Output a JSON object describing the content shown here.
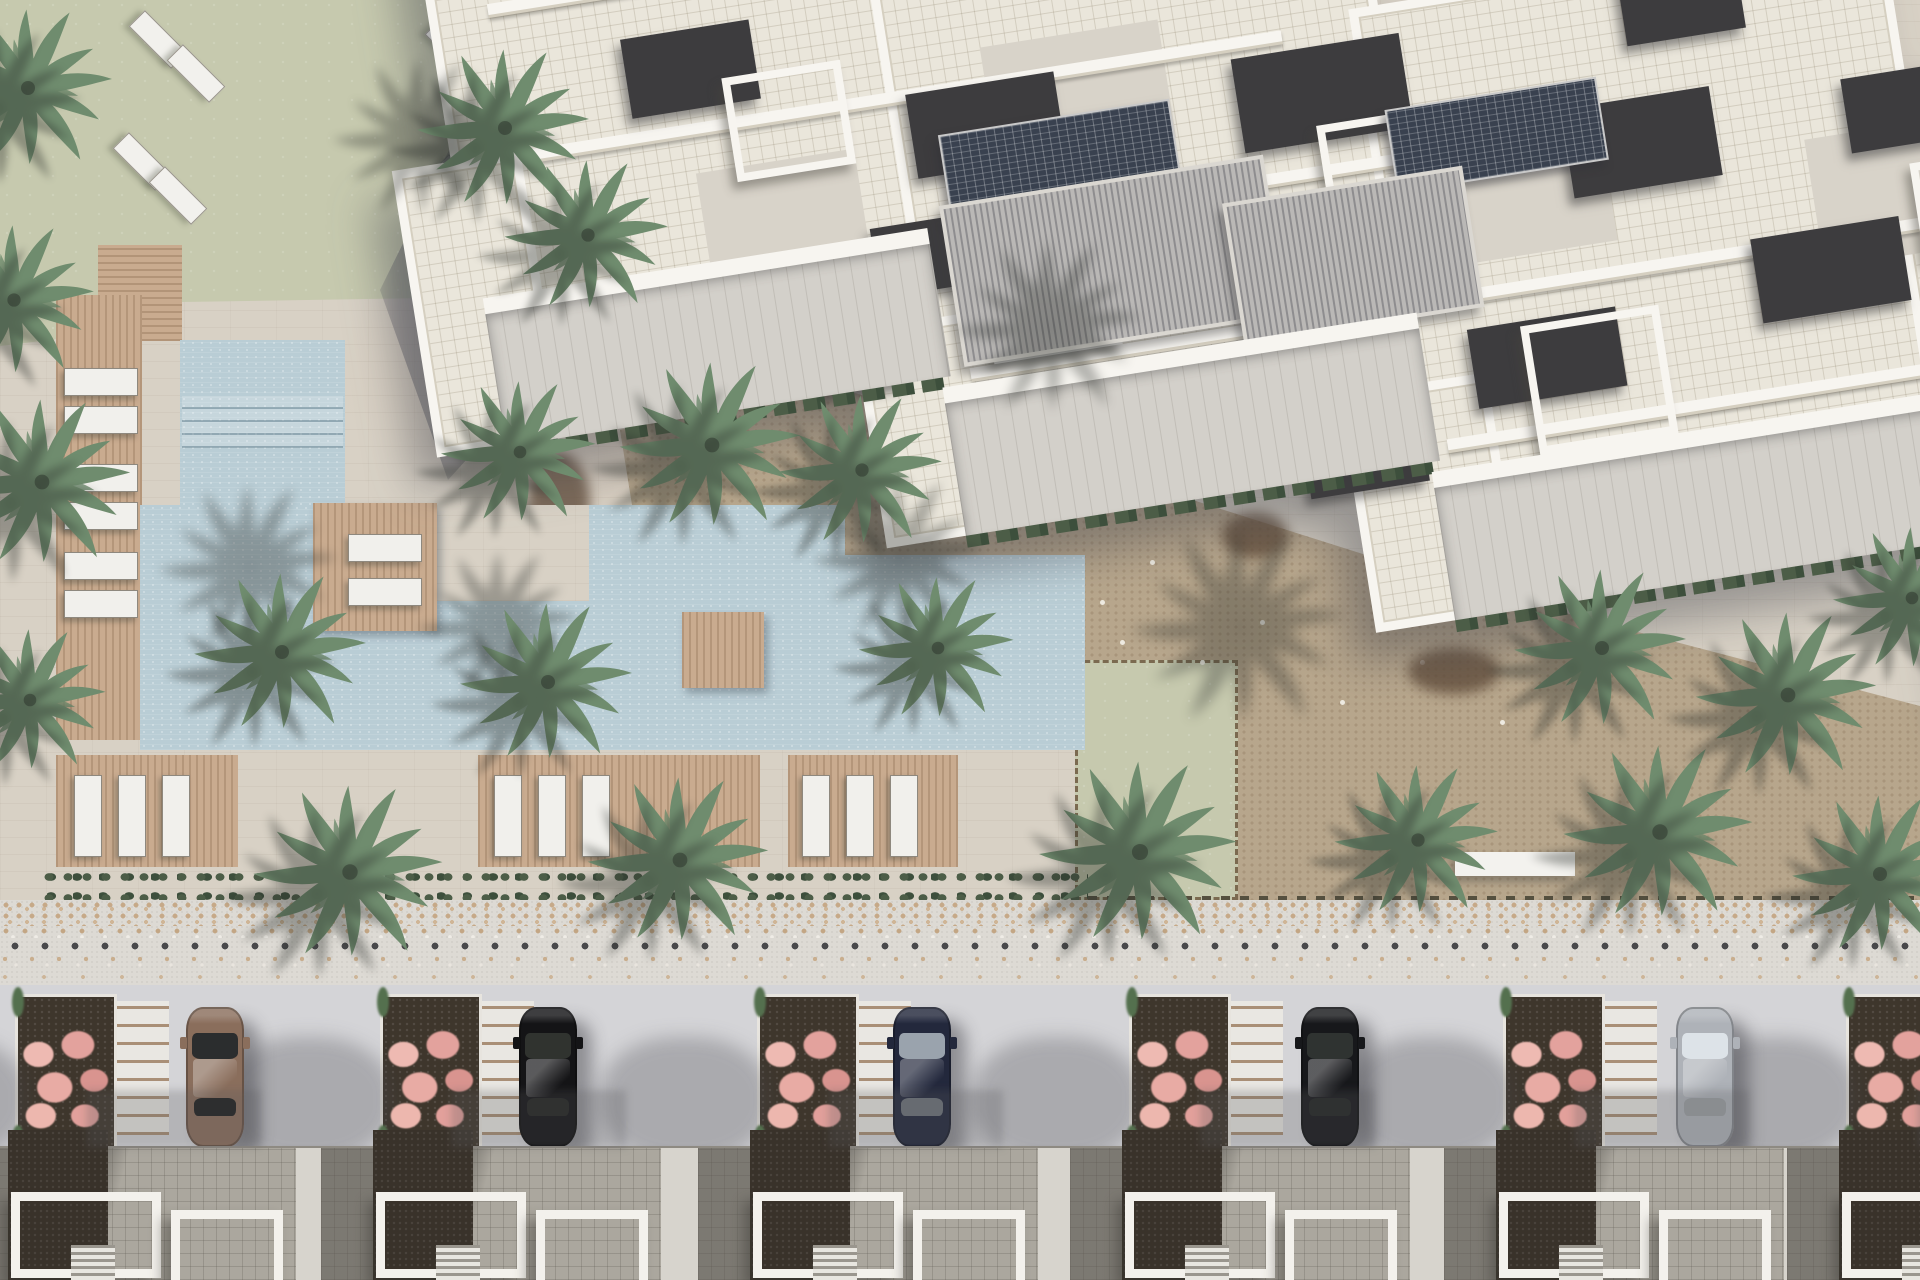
{
  "scene": {
    "type": "aerial-architectural-render",
    "description": "top-down site plan of residential resort: pool with wood decks, lawn, apartment building with solar panels, palm plaza, promenade, street parking, townhouses"
  },
  "palette": {
    "pav": "#d8d1c5",
    "lawn": "#c6c9ae",
    "water": "#b9cdd5",
    "wood": "#c9ab8f",
    "plaza": "#b7a68c",
    "walk": "#dddad4",
    "street": "#d4d4d7",
    "cream": "#eae6db",
    "charcoal": "#3d3c3e",
    "solar": "#39414f",
    "pink": "#e8aba4",
    "palm": "#6f8c6e",
    "white": "#f3f1ec"
  },
  "lawnLoungers": [
    {
      "x": 128,
      "y": 28,
      "r": "45deg"
    },
    {
      "x": 166,
      "y": 62,
      "r": "45deg"
    },
    {
      "x": 112,
      "y": 150,
      "r": "45deg"
    },
    {
      "x": 148,
      "y": 184,
      "r": "45deg"
    },
    {
      "x": 424,
      "y": 36,
      "r": "45deg"
    },
    {
      "x": 460,
      "y": 70,
      "r": "45deg"
    },
    {
      "x": 432,
      "y": 172,
      "r": "45deg",
      "cls": "shade"
    }
  ],
  "deckLoungers": [
    {
      "x": 64,
      "y": 368
    },
    {
      "x": 64,
      "y": 406
    },
    {
      "x": 64,
      "y": 464
    },
    {
      "x": 64,
      "y": 502
    },
    {
      "x": 64,
      "y": 552
    },
    {
      "x": 64,
      "y": 590
    }
  ],
  "islandLoungers": [
    {
      "x": 348,
      "y": 534
    },
    {
      "x": 348,
      "y": 578
    }
  ],
  "platforms": [
    {
      "x": 56,
      "y": 755,
      "w": 182
    },
    {
      "x": 478,
      "y": 755,
      "w": 282
    },
    {
      "x": 788,
      "y": 755,
      "w": 170
    }
  ],
  "platformLoungers": [
    {
      "x": 74,
      "y": 775
    },
    {
      "x": 118,
      "y": 775
    },
    {
      "x": 162,
      "y": 775
    },
    {
      "x": 494,
      "y": 775
    },
    {
      "x": 538,
      "y": 775
    },
    {
      "x": 582,
      "y": 775
    },
    {
      "x": 802,
      "y": 775
    },
    {
      "x": 846,
      "y": 775
    },
    {
      "x": 890,
      "y": 775
    }
  ],
  "palms": [
    {
      "x": 28,
      "y": 88,
      "s": "1"
    },
    {
      "x": 14,
      "y": 300,
      "s": "0.95"
    },
    {
      "x": 42,
      "y": 482,
      "s": "1.05"
    },
    {
      "x": 30,
      "y": 700,
      "s": "0.9"
    },
    {
      "x": 505,
      "y": 128,
      "s": "1"
    },
    {
      "x": 588,
      "y": 235,
      "s": "0.95"
    },
    {
      "x": 520,
      "y": 452,
      "s": "0.9"
    },
    {
      "x": 712,
      "y": 445,
      "s": "1.05"
    },
    {
      "x": 862,
      "y": 470,
      "s": "0.95"
    },
    {
      "x": 282,
      "y": 652,
      "s": "1"
    },
    {
      "x": 548,
      "y": 682,
      "s": "1"
    },
    {
      "x": 938,
      "y": 648,
      "s": "0.9"
    },
    {
      "x": 350,
      "y": 872,
      "s": "1.1"
    },
    {
      "x": 680,
      "y": 860,
      "s": "1.05"
    },
    {
      "x": 1140,
      "y": 852,
      "s": "1.15"
    },
    {
      "x": 1418,
      "y": 840,
      "s": "0.95"
    },
    {
      "x": 1660,
      "y": 832,
      "s": "1.1"
    },
    {
      "x": 1880,
      "y": 874,
      "s": "1"
    },
    {
      "x": 1602,
      "y": 648,
      "s": "1"
    },
    {
      "x": 1788,
      "y": 695,
      "s": "1.05"
    },
    {
      "x": 1912,
      "y": 598,
      "s": "0.9"
    }
  ],
  "palmShadows": [
    {
      "x": 250,
      "y": 570,
      "s": "1.05"
    },
    {
      "x": 500,
      "y": 628,
      "s": "0.95"
    },
    {
      "x": 900,
      "y": 560,
      "s": "1"
    },
    {
      "x": 1240,
      "y": 630,
      "s": "1.25"
    },
    {
      "x": 420,
      "y": 140,
      "s": "1"
    },
    {
      "x": 1050,
      "y": 330,
      "s": "1.1"
    }
  ],
  "building": {
    "wings": [
      {
        "x": 60,
        "y": 20,
        "w": 470,
        "h": 600
      },
      {
        "x": 500,
        "y": 170,
        "w": 500,
        "h": 610
      },
      {
        "x": 970,
        "y": 320,
        "w": 540,
        "h": 620
      },
      {
        "x": 1480,
        "y": 470,
        "w": 420,
        "h": 630
      },
      {
        "x": 0,
        "y": 330,
        "w": 130,
        "h": 290
      },
      {
        "x": 430,
        "y": 560,
        "w": 150,
        "h": 220
      },
      {
        "x": 900,
        "y": 700,
        "w": 150,
        "h": 240
      }
    ],
    "bands": [
      {
        "x": 140,
        "y": 330,
        "w": 760
      },
      {
        "x": 300,
        "y": 470,
        "w": 800
      },
      {
        "x": 540,
        "y": 615,
        "w": 960
      },
      {
        "x": 1000,
        "y": 760,
        "w": 800
      },
      {
        "x": 120,
        "y": 180,
        "w": 600
      }
    ],
    "charcoal": [
      {
        "x": 519,
        "y": 335,
        "w": 150,
        "h": 85
      },
      {
        "x": 846,
        "y": 351,
        "w": 170,
        "h": 95
      },
      {
        "x": 246,
        "y": 236,
        "w": 130,
        "h": 80
      },
      {
        "x": 463,
        "y": 462,
        "w": 120,
        "h": 70
      },
      {
        "x": 1164,
        "y": 452,
        "w": 150,
        "h": 90
      },
      {
        "x": 1037,
        "y": 655,
        "w": 150,
        "h": 80
      },
      {
        "x": 857,
        "y": 728,
        "w": 120,
        "h": 70
      },
      {
        "x": 1331,
        "y": 610,
        "w": 150,
        "h": 85
      },
      {
        "x": 1445,
        "y": 466,
        "w": 130,
        "h": 75
      },
      {
        "x": 380,
        "y": 560,
        "w": 100,
        "h": 60
      },
      {
        "x": 700,
        "y": 640,
        "w": 110,
        "h": 65
      },
      {
        "x": 1240,
        "y": 330,
        "w": 120,
        "h": 70
      }
    ],
    "whiteFrames": [
      {
        "x": 565,
        "y": 505,
        "w": 130,
        "h": 110
      },
      {
        "x": 1090,
        "y": 660,
        "w": 140,
        "h": 130
      },
      {
        "x": 340,
        "y": 290,
        "w": 120,
        "h": 105
      },
      {
        "x": 920,
        "y": 430,
        "w": 110,
        "h": 95
      },
      {
        "x": 1500,
        "y": 560,
        "w": 120,
        "h": 100
      }
    ],
    "roofPatches": [
      {
        "x": 600,
        "y": 300,
        "w": 180,
        "h": 120
      },
      {
        "x": 1000,
        "y": 450,
        "w": 200,
        "h": 140
      },
      {
        "x": 1400,
        "y": 520,
        "w": 180,
        "h": 130
      },
      {
        "x": 300,
        "y": 380,
        "w": 160,
        "h": 110
      }
    ],
    "solar": [
      {
        "x": 545,
        "y": 380,
        "w": 230,
        "h": 85
      },
      {
        "x": 990,
        "y": 425,
        "w": 210,
        "h": 80
      }
    ],
    "pergolas": [
      {
        "x": 535,
        "y": 450,
        "w": 320,
        "h": 155
      },
      {
        "x": 815,
        "y": 492,
        "w": 235,
        "h": 135
      }
    ],
    "terraces": [
      {
        "x": 70,
        "y": 470,
        "w": 450,
        "h": 150
      },
      {
        "x": 510,
        "y": 630,
        "w": 480,
        "h": 150
      },
      {
        "x": 980,
        "y": 790,
        "w": 520,
        "h": 150
      },
      {
        "x": 1490,
        "y": 950,
        "w": 400,
        "h": 150
      }
    ]
  },
  "plaza": {
    "bench": {
      "x": 1455,
      "y": 852,
      "w": 120,
      "h": 24
    },
    "specks": [
      {
        "x": 1060,
        "y": 560
      },
      {
        "x": 1100,
        "y": 600
      },
      {
        "x": 1150,
        "y": 560
      },
      {
        "x": 1120,
        "y": 640
      },
      {
        "x": 1200,
        "y": 660
      },
      {
        "x": 1260,
        "y": 620
      },
      {
        "x": 1340,
        "y": 700
      },
      {
        "x": 1420,
        "y": 660
      },
      {
        "x": 1500,
        "y": 720
      },
      {
        "x": 1580,
        "y": 680
      }
    ],
    "bushes": [
      {
        "x": 528,
        "y": 452,
        "w": 62,
        "h": 100
      },
      {
        "x": 1408,
        "y": 648,
        "w": 92,
        "h": 46
      },
      {
        "x": 1222,
        "y": 512,
        "w": 66,
        "h": 46
      }
    ],
    "greenPatch": {
      "x": 1075,
      "y": 660,
      "w": 163,
      "h": 240
    }
  },
  "parking": {
    "planters": [
      {
        "x": 18
      },
      {
        "x": 383
      },
      {
        "x": 760
      },
      {
        "x": 1132
      },
      {
        "x": 1506
      },
      {
        "x": 1849
      }
    ],
    "cars": [
      {
        "x": 186,
        "c": "#8a6e5c",
        "g": "#2b2d2e"
      },
      {
        "x": 519,
        "c": "#141416",
        "g": "#30332f"
      },
      {
        "x": 893,
        "c": "#23283c",
        "g": "#9aa3ad"
      },
      {
        "x": 1301,
        "c": "#17181b",
        "g": "#2f3331"
      },
      {
        "x": 1676,
        "c": "#aeb2b8",
        "g": "#dde3e8"
      }
    ]
  },
  "townhouses": {
    "units": [
      {
        "x": -44
      },
      {
        "x": 321
      },
      {
        "x": 698
      },
      {
        "x": 1070
      },
      {
        "x": 1444
      },
      {
        "x": 1787
      }
    ]
  }
}
